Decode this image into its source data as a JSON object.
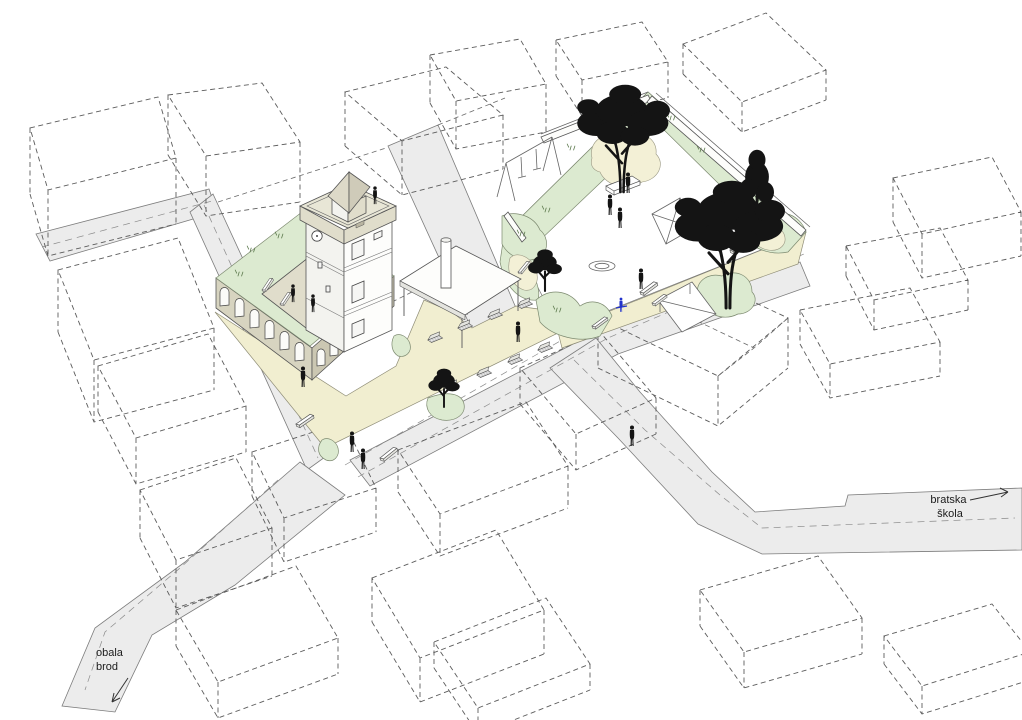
{
  "diagram": {
    "kind": "architectural axonometric site diagram",
    "labels": {
      "road_right": {
        "line1": "bratska",
        "line2": "škola",
        "arrow_direction": "right"
      },
      "road_bottom_left": {
        "line1": "obala",
        "line2": "brod",
        "arrow_direction": "down-left"
      }
    },
    "colors": {
      "background": "#ffffff",
      "road_fill": "#ececec",
      "plaza_fill": "#f1eed0",
      "lawn_fill": "#dcead0",
      "sand_fill": "#f3f0d6",
      "building_wall_khaki": "#d7d4c0",
      "building_trim": "#e0ddcb",
      "outline_gray": "#5c5c5c",
      "figure_black": "#141414",
      "figure_blue_accent": "#2233cc"
    }
  }
}
